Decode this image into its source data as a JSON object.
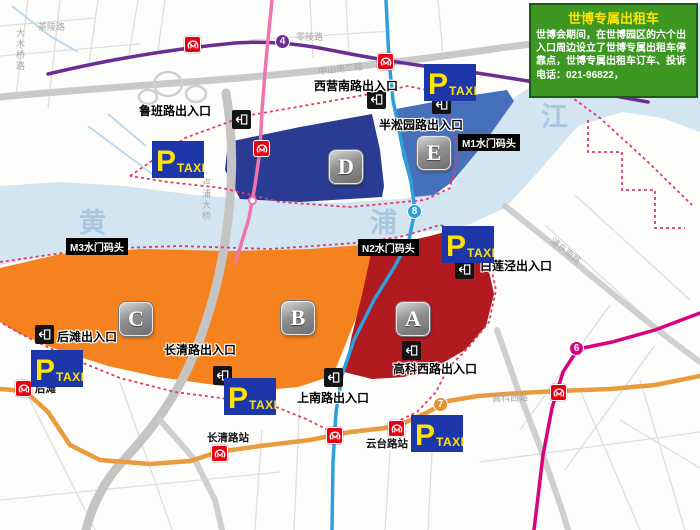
{
  "info_box": {
    "title": "世博专属出租车",
    "body": "世博会期间，在世博园区的六个出入口周边设立了世博专属出租车停靠点，世博专属出租车订车、投诉电话：021-96822，"
  },
  "taxi_sign": {
    "p": "P",
    "label": "TAXI"
  },
  "zones": {
    "a": "A",
    "b": "B",
    "c": "C",
    "d": "D",
    "e": "E"
  },
  "zone_colors": {
    "a": "#b11b20",
    "bc": "#f5821f",
    "d": "#2a3b94",
    "e": "#4670bc"
  },
  "entrances": {
    "luban": "鲁班路出入口",
    "xiying": "西营南路出入口",
    "bansongyuan": "半淞园路出入口",
    "bailianjing": "白莲泾出入口",
    "houtan": "后滩出入口",
    "changqing": "长清路出入口",
    "shangnan": "上南路出入口",
    "gaokexi": "高科西路出入口"
  },
  "wharves": {
    "m1": "M1水门码头",
    "n2": "N2水门码头",
    "m3": "M3水门码头"
  },
  "stations": {
    "houtan": "后滩",
    "changqing": "长清路站",
    "yuntai": "云台路站"
  },
  "river": {
    "c1": "黄",
    "c2": "浦",
    "c3": "江"
  },
  "streets": {
    "damuqiao": "大木桥路",
    "chaling": "茶陵路",
    "lingling": "零陵路",
    "zhongshan": "中山南二路",
    "lupu": "卢浦大桥",
    "pudongnan": "浦东南路",
    "gaokexi": "高科西路"
  },
  "metro": {
    "line4": "4",
    "line8": "8",
    "line6": "6",
    "line7": "7"
  },
  "line_colors": {
    "line4": "#6b2d91",
    "line8": "#2e9fdb",
    "line6": "#d9017e",
    "line7": "#e89c3e",
    "line13": "#f173ac"
  }
}
